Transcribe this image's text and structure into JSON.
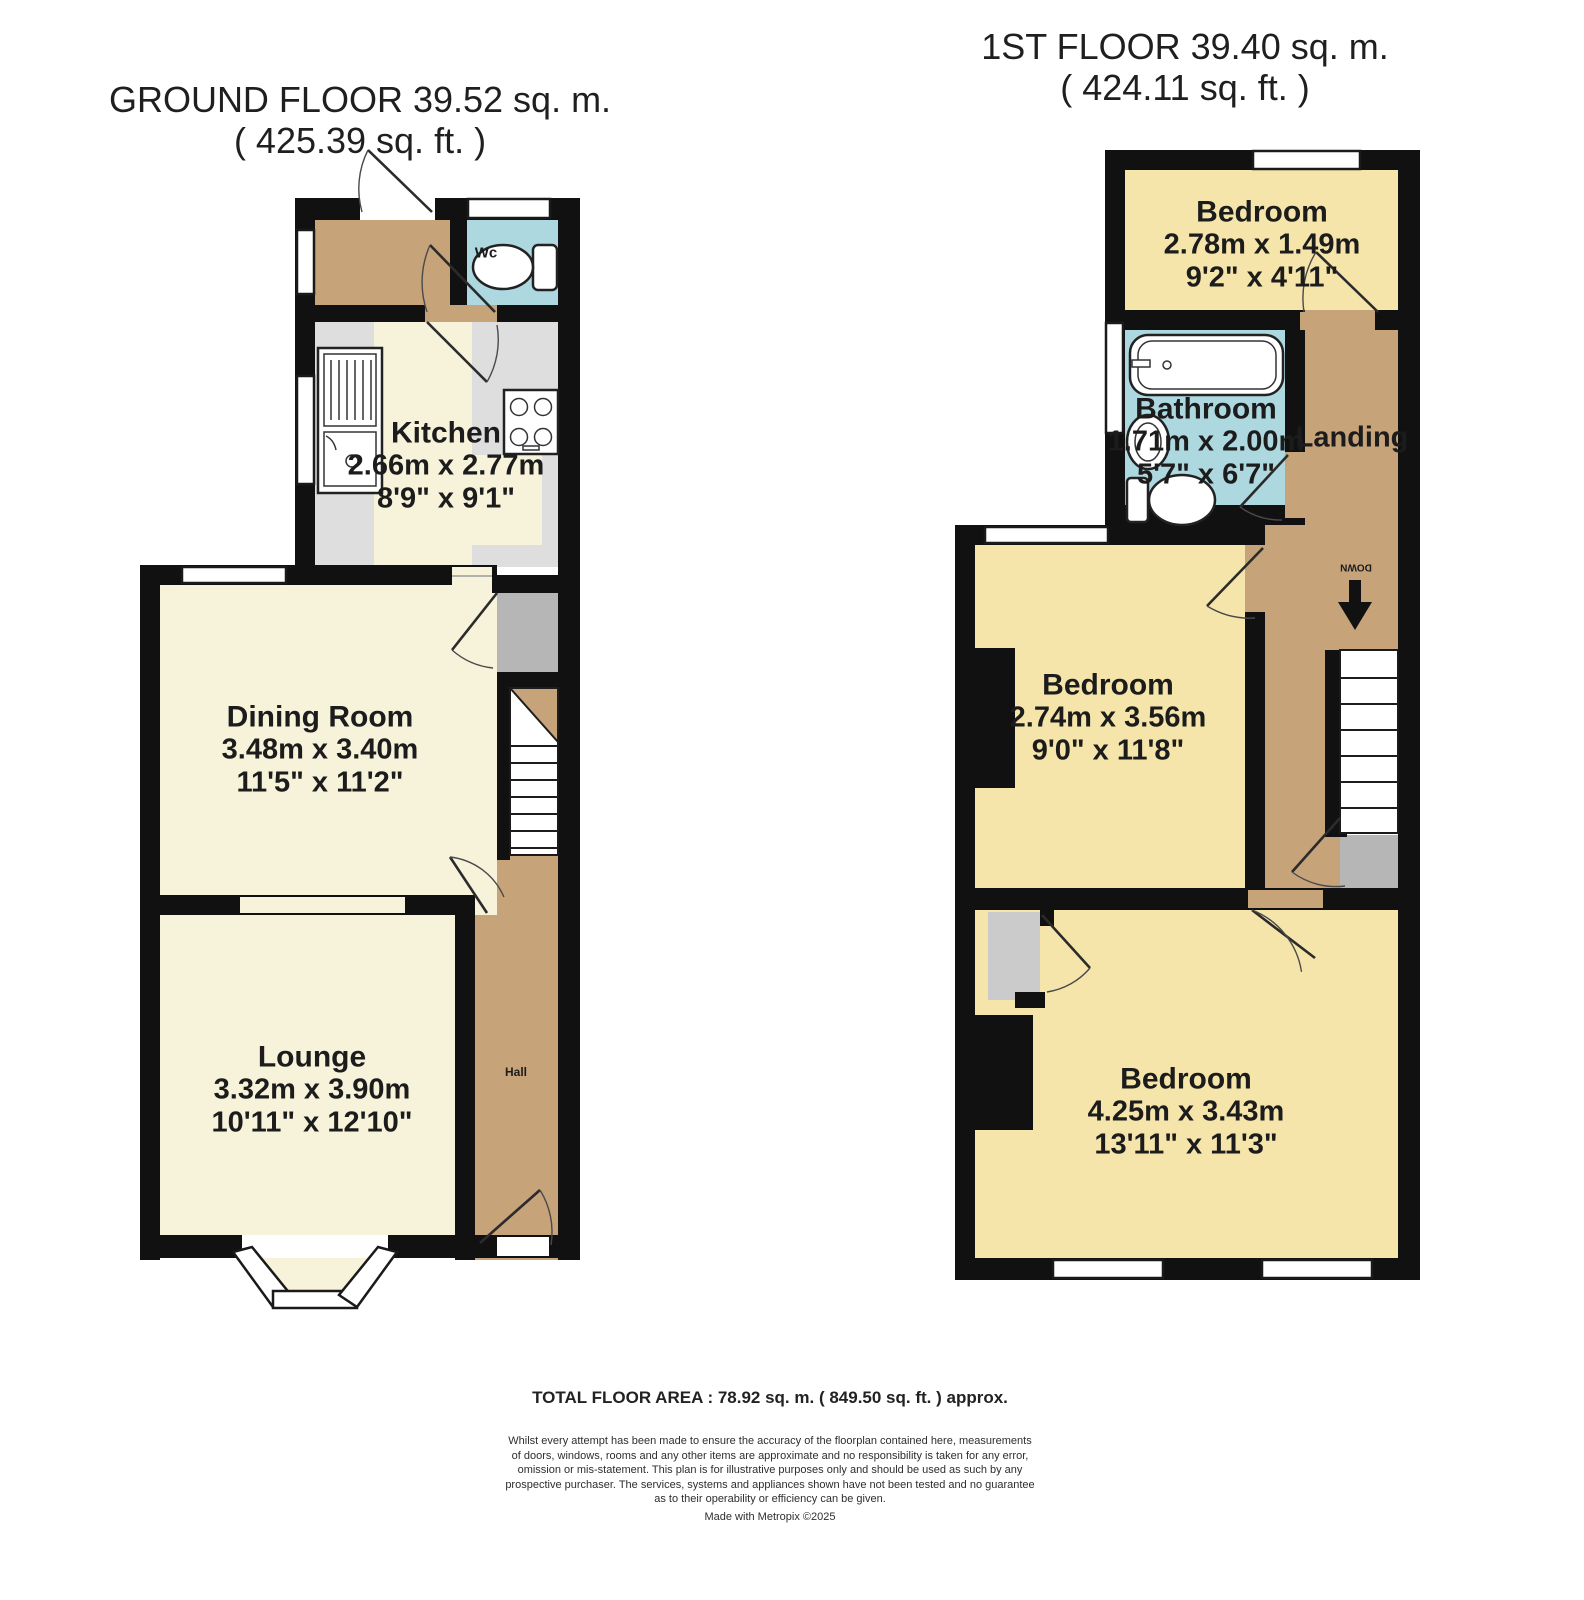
{
  "ground": {
    "title": "GROUND FLOOR 39.52 sq. m.",
    "subtitle": "( 425.39 sq. ft. )",
    "rooms": {
      "kitchen": {
        "name": "Kitchen",
        "metric": "2.66m x 2.77m",
        "imperial": "8'9\" x 9'1\""
      },
      "dining": {
        "name": "Dining Room",
        "metric": "3.48m x 3.40m",
        "imperial": "11'5\" x 11'2\""
      },
      "lounge": {
        "name": "Lounge",
        "metric": "3.32m x 3.90m",
        "imperial": "10'11\" x 12'10\""
      },
      "wc": {
        "name": "Wc"
      },
      "hall": {
        "name": "Hall"
      }
    }
  },
  "first": {
    "title": "1ST FLOOR 39.40 sq. m.",
    "subtitle": "( 424.11 sq. ft. )",
    "rooms": {
      "bedroom1": {
        "name": "Bedroom",
        "metric": "2.78m x 1.49m",
        "imperial": "9'2\" x 4'11\""
      },
      "bathroom": {
        "name": "Bathroom",
        "metric": "1.71m x 2.00m",
        "imperial": "5'7\" x 6'7\""
      },
      "bedroom2": {
        "name": "Bedroom",
        "metric": "2.74m x 3.56m",
        "imperial": "9'0\" x 11'8\""
      },
      "bedroom3": {
        "name": "Bedroom",
        "metric": "4.25m x 3.43m",
        "imperial": "13'11\" x 11'3\""
      },
      "landing": {
        "name": "Landing"
      }
    },
    "stairs": {
      "down_label": "DOWN"
    }
  },
  "footer": {
    "total": "TOTAL FLOOR AREA : 78.92 sq. m. ( 849.50 sq. ft. ) approx.",
    "disclaimer": "Whilst every attempt has been made to ensure the accuracy of the floorplan contained here, measurements of doors, windows, rooms and any other items are approximate and no responsibility is taken for any error, omission or mis-statement. This plan is for illustrative purposes only and should be used as such by any prospective purchaser. The services, systems and appliances shown have not been tested and no guarantee as to their operability or efficiency can be given.",
    "credit": "Made with Metropix ©2025"
  },
  "colors": {
    "wall": "#111111",
    "ground_floor_fill": "#f7f2da",
    "bedroom_fill": "#f5e5aa",
    "hall_landing_fill": "#c6a379",
    "bathroom_wc_fill": "#aed8e0",
    "counter_gray": "#dedede",
    "alcove_gray": "#b6b6b6",
    "closet_gray": "#cbcbcb"
  }
}
